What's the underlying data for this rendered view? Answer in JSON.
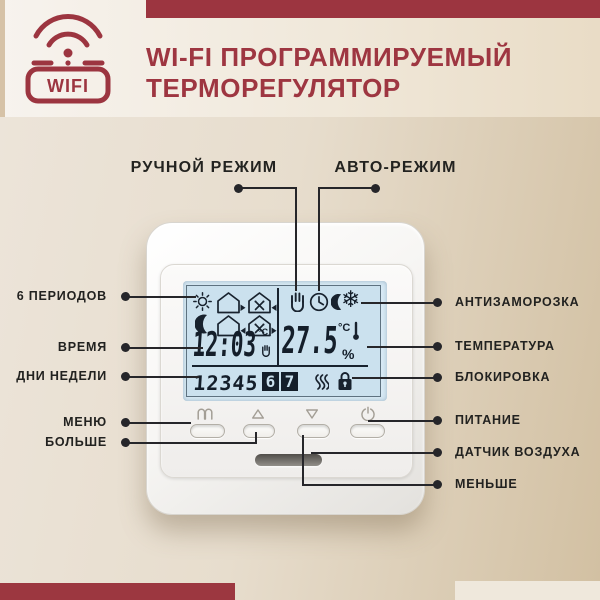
{
  "header": {
    "badge": "WIFI",
    "title_line1": "WI-FI ПРОГРАММИРУЕМЫЙ",
    "title_line2": "ТЕРМОРЕГУЛЯТОР"
  },
  "callouts": {
    "top": [
      {
        "label": "РУЧНОЙ РЕЖИМ"
      },
      {
        "label": "АВТО-РЕЖИМ"
      }
    ],
    "left": [
      {
        "label": "6 ПЕРИОДОВ"
      },
      {
        "label": "ВРЕМЯ"
      },
      {
        "label": "ДНИ НЕДЕЛИ"
      },
      {
        "label": "МЕНЮ"
      },
      {
        "label": "БОЛЬШЕ"
      }
    ],
    "right": [
      {
        "label": "АНТИЗАМОРОЗКА"
      },
      {
        "label": "ТЕМПЕРАТУРА"
      },
      {
        "label": "БЛОКИРОВКА"
      },
      {
        "label": "ПИТАНИЕ"
      },
      {
        "label": "ДАТЧИК ВОЗДУХА"
      },
      {
        "label": "МЕНЬШЕ"
      }
    ]
  },
  "thermostat": {
    "display": {
      "time": "12:03",
      "time_unit": "°C",
      "temperature": "27.5",
      "temperature_unit": "°C",
      "humidity_symbol": "%",
      "days": [
        {
          "label": "1",
          "active": false
        },
        {
          "label": "2",
          "active": false
        },
        {
          "label": "3",
          "active": false
        },
        {
          "label": "4",
          "active": false
        },
        {
          "label": "5",
          "active": false
        },
        {
          "label": "6",
          "active": true
        },
        {
          "label": "7",
          "active": true
        }
      ],
      "icons": {
        "left_grid": [
          "sun-icon",
          "house-out-icon",
          "house-fan-in-icon",
          "moon-icon",
          "house-in-icon",
          "house-fan-out-icon"
        ],
        "right_row": [
          "hand-icon",
          "clock-icon",
          "moon-small-icon",
          "snowflake-icon"
        ],
        "bottom_row": [
          "heating-waves-icon",
          "lock-icon"
        ],
        "snowflake_glyph": "❄"
      }
    },
    "buttons": [
      {
        "name": "menu"
      },
      {
        "name": "up"
      },
      {
        "name": "down"
      },
      {
        "name": "power"
      }
    ]
  },
  "colors": {
    "accent_red": "#9c3540",
    "lcd_background": "#cbe1ee",
    "lcd_ink": "#18222e",
    "background_tan": "#d2c0a2",
    "label_text": "#222220"
  }
}
